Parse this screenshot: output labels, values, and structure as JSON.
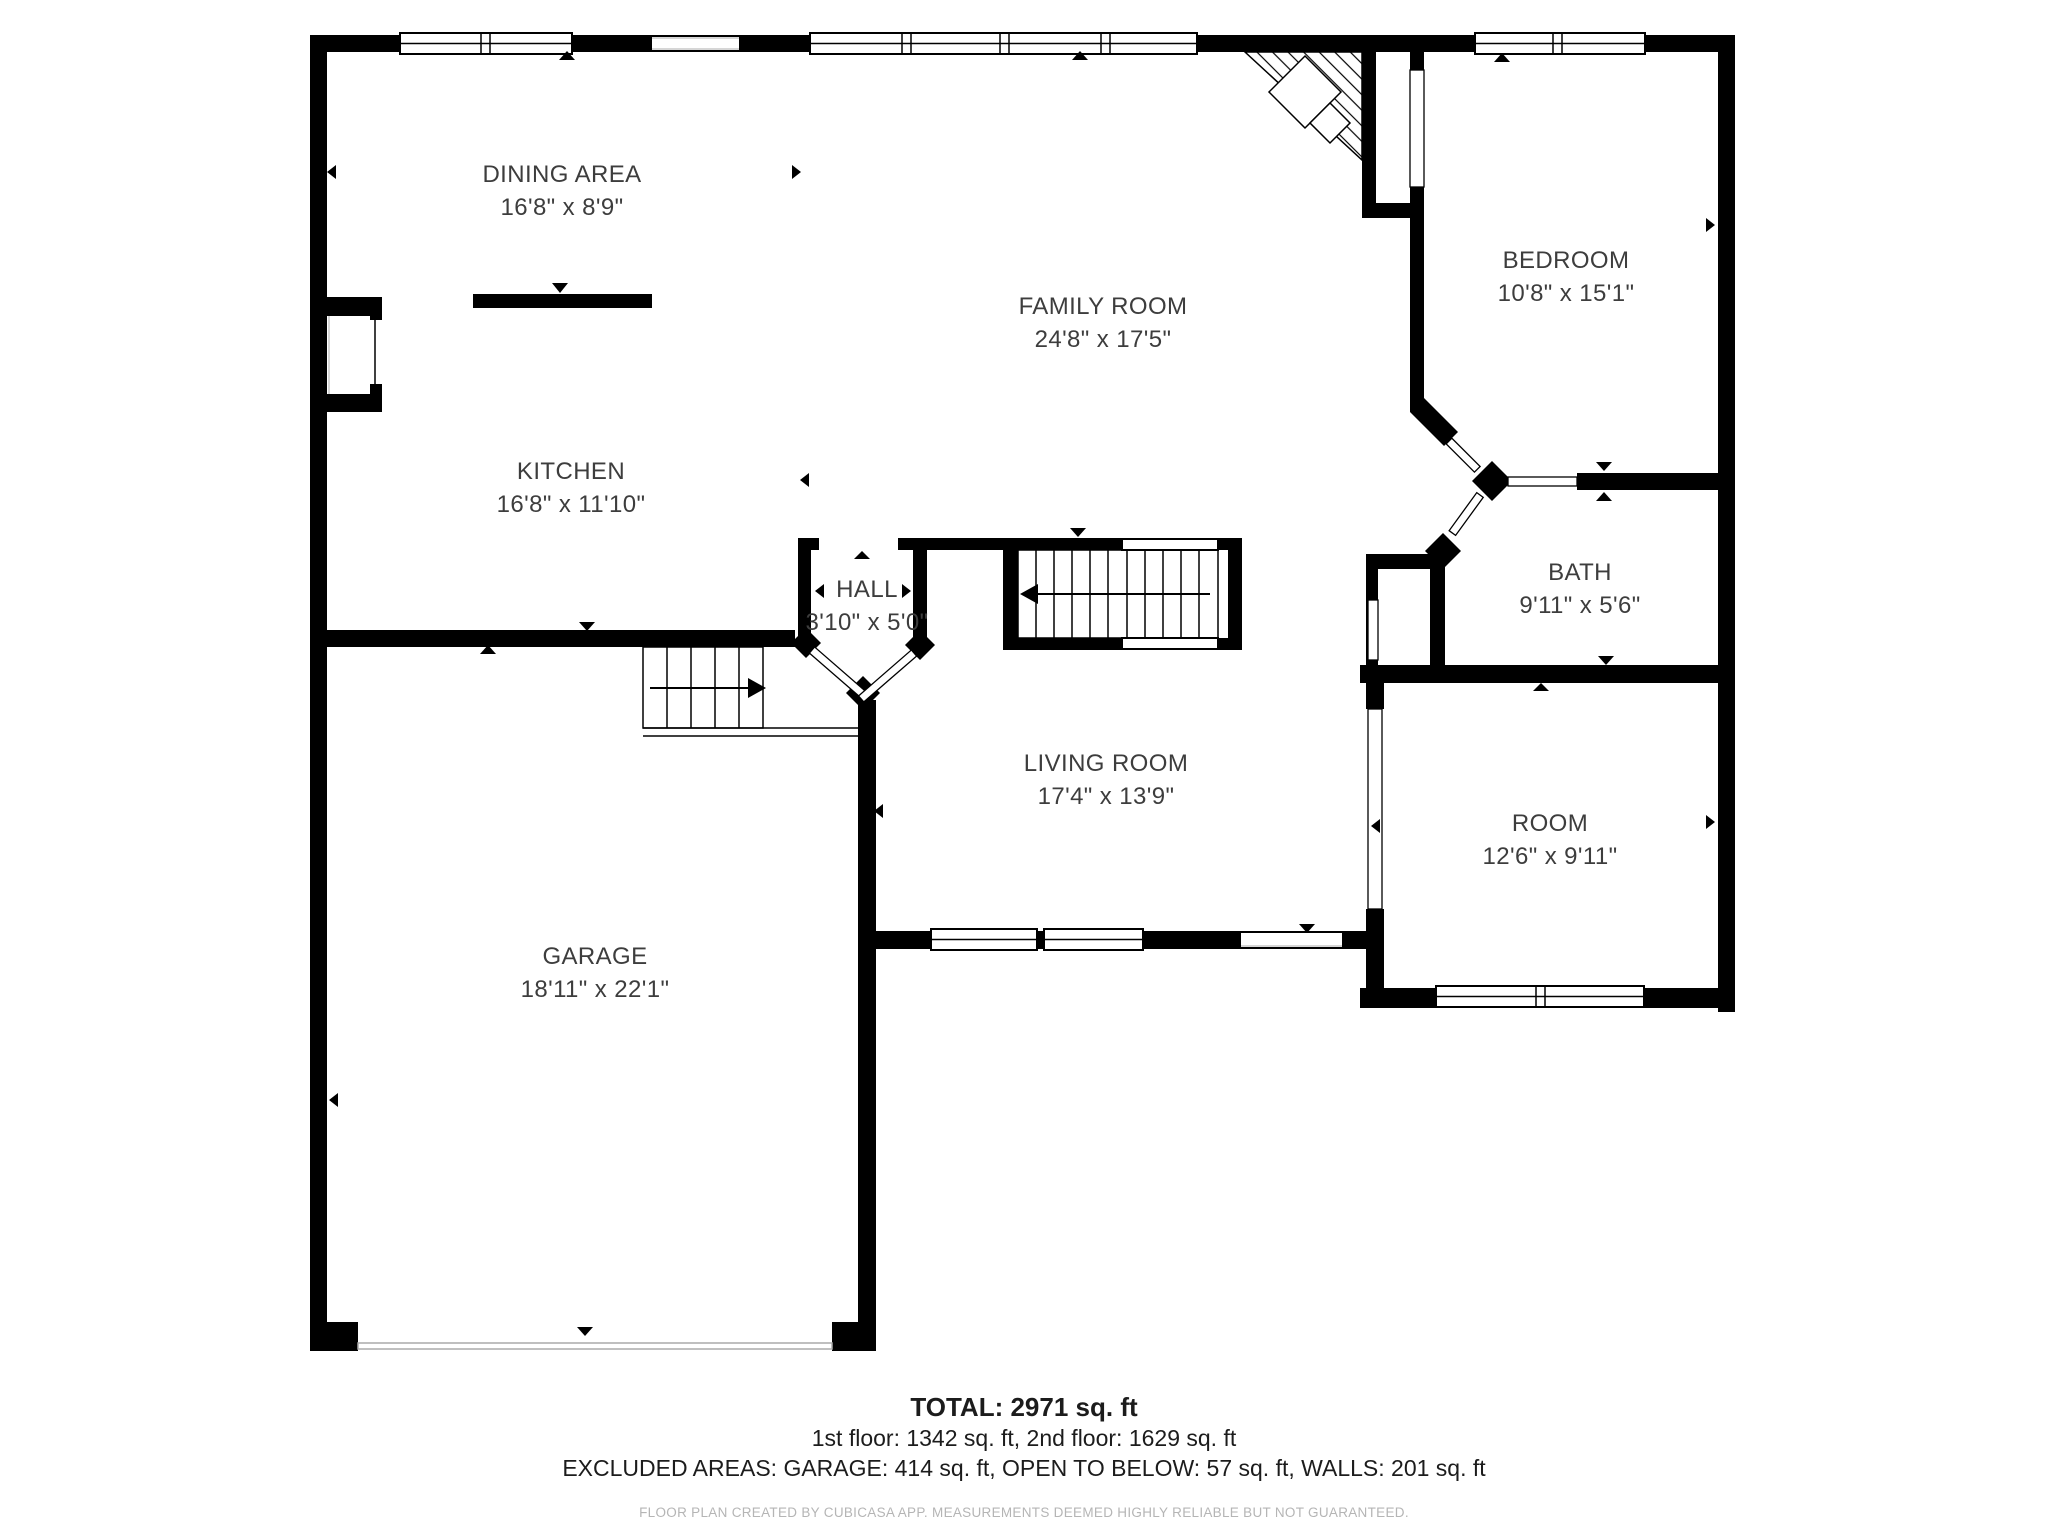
{
  "floor_plan": {
    "rooms": [
      {
        "id": "dining",
        "name": "DINING AREA",
        "dimensions": "16'8\" x 8'9\""
      },
      {
        "id": "kitchen",
        "name": "KITCHEN",
        "dimensions": "16'8\" x 11'10\""
      },
      {
        "id": "family",
        "name": "FAMILY ROOM",
        "dimensions": "24'8\" x 17'5\""
      },
      {
        "id": "bedroom",
        "name": "BEDROOM",
        "dimensions": "10'8\" x 15'1\""
      },
      {
        "id": "hall",
        "name": "HALL",
        "dimensions": "3'10\" x 5'0\""
      },
      {
        "id": "bath",
        "name": "BATH",
        "dimensions": "9'11\" x 5'6\""
      },
      {
        "id": "living",
        "name": "LIVING ROOM",
        "dimensions": "17'4\" x 13'9\""
      },
      {
        "id": "room",
        "name": "ROOM",
        "dimensions": "12'6\" x 9'11\""
      },
      {
        "id": "garage",
        "name": "GARAGE",
        "dimensions": "18'11\" x 22'1\""
      }
    ],
    "summary": {
      "total": "TOTAL: 2971 sq. ft",
      "floors": "1st floor: 1342 sq. ft, 2nd floor: 1629 sq. ft",
      "excluded": "EXCLUDED AREAS: GARAGE: 414 sq. ft, OPEN TO BELOW: 57 sq. ft, WALLS: 201 sq. ft"
    },
    "disclaimer": "FLOOR PLAN CREATED BY CUBICASA APP. MEASUREMENTS DEEMED HIGHLY RELIABLE BUT NOT GUARANTEED.",
    "colors": {
      "wall": "#000000",
      "background": "#ffffff",
      "label": "#3d3d3d",
      "disclaimer": "#b5b5b5"
    }
  }
}
